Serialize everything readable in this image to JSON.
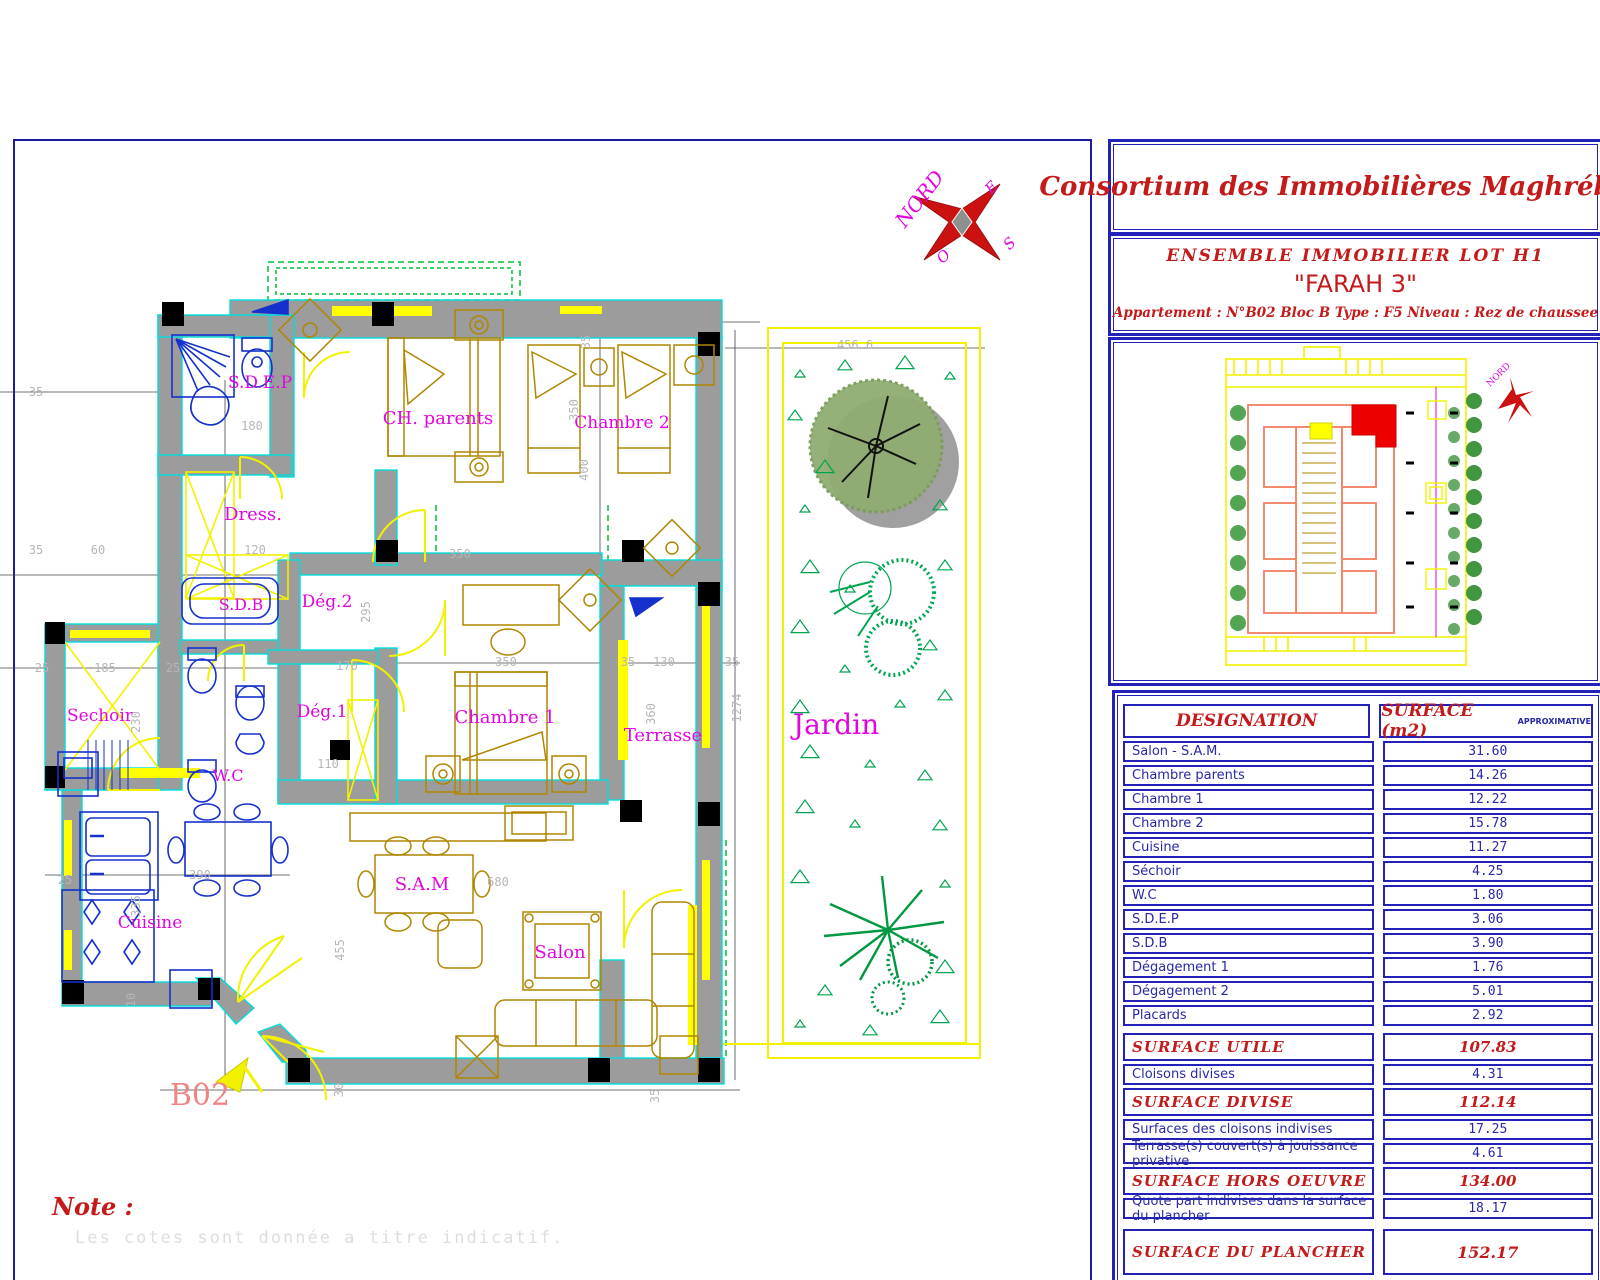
{
  "company": {
    "title": "Consortium des Immobilières Maghrébines"
  },
  "project": {
    "line1": "ENSEMBLE   IMMOBILIER LOT H1",
    "line2": "\"FARAH 3\"",
    "line3": "Appartement :  N°B02 Bloc B     Type : F5      Niveau : Rez de chaussee"
  },
  "plan_masse": {
    "label_line1": "PLAN",
    "label_line2": "MASSE"
  },
  "surface_table": {
    "header": {
      "designation": "DESIGNATION",
      "surface": "SURFACE  (m2)",
      "approx": "APPROXIMATIVE"
    },
    "rows": [
      {
        "label": "Salon - S.A.M.",
        "value": "31.60",
        "style": "normal"
      },
      {
        "label": "Chambre parents",
        "value": "14.26",
        "style": "normal"
      },
      {
        "label": "Chambre 1",
        "value": "12.22",
        "style": "normal"
      },
      {
        "label": "Chambre 2",
        "value": "15.78",
        "style": "normal"
      },
      {
        "label": "Cuisine",
        "value": "11.27",
        "style": "normal"
      },
      {
        "label": "Séchoir",
        "value": "4.25",
        "style": "normal"
      },
      {
        "label": "W.C",
        "value": "1.80",
        "style": "normal"
      },
      {
        "label": "S.D.E.P",
        "value": "3.06",
        "style": "normal"
      },
      {
        "label": "S.D.B",
        "value": "3.90",
        "style": "normal"
      },
      {
        "label": "Dégagement 1",
        "value": "1.76",
        "style": "normal"
      },
      {
        "label": "Dégagement 2",
        "value": "5.01",
        "style": "normal"
      },
      {
        "label": "Placards",
        "value": "2.92",
        "style": "normal"
      },
      {
        "label": "SURFACE  UTILE",
        "value": "107.83",
        "style": "section",
        "gap": 7
      },
      {
        "label": "Cloisons divises",
        "value": "4.31",
        "style": "normal"
      },
      {
        "label": "SURFACE  DIVISE",
        "value": "112.14",
        "style": "section"
      },
      {
        "label": "Surfaces  des  cloisons  indivises",
        "value": "17.25",
        "style": "normal"
      },
      {
        "label": "Terrasse(s)  couvert(s)  à  jouissance  privative",
        "value": "4.61",
        "style": "normal"
      },
      {
        "label": "SURFACE  HORS  OEUVRE",
        "value": "134.00",
        "style": "section"
      },
      {
        "label": "Quote  part  indivises  dans  la  surface  du  plancher",
        "value": "18.17",
        "style": "normal"
      },
      {
        "label": "SURFACE  DU  PLANCHER",
        "value": "152.17",
        "style": "plancher",
        "gap": 10
      },
      {
        "label": "Jardin",
        "value": "56.50",
        "style": "redrow",
        "gap": 10
      },
      {
        "label": "Numéro  de  la  place  de  parking",
        "value": "--",
        "style": "redrow"
      }
    ]
  },
  "floor_plan": {
    "note_title": "Note :",
    "note_text": "Les cotes sont donnée a titre indicatif.",
    "compass": {
      "n": "NORD",
      "e": "E",
      "s": "S",
      "o": "O"
    },
    "labels": [
      {
        "t": "S.D.E.P",
        "x": 260,
        "y": 388,
        "s": 17
      },
      {
        "t": "Dress.",
        "x": 253,
        "y": 520,
        "s": 18
      },
      {
        "t": "CH. parents",
        "x": 438,
        "y": 424,
        "s": 18
      },
      {
        "t": "Chambre 2",
        "x": 622,
        "y": 428,
        "s": 17
      },
      {
        "t": "S.D.B",
        "x": 241,
        "y": 610,
        "s": 16
      },
      {
        "t": "Dég.2",
        "x": 327,
        "y": 607,
        "s": 17
      },
      {
        "t": "Sechoir",
        "x": 100,
        "y": 721,
        "s": 17
      },
      {
        "t": "Dég.1",
        "x": 322,
        "y": 717,
        "s": 17
      },
      {
        "t": "Chambre 1",
        "x": 505,
        "y": 723,
        "s": 18
      },
      {
        "t": "Terrasse",
        "x": 663,
        "y": 741,
        "s": 18
      },
      {
        "t": "Jardin",
        "x": 836,
        "y": 734,
        "s": 28
      },
      {
        "t": "W.C",
        "x": 228,
        "y": 781,
        "s": 16
      },
      {
        "t": "Cuisine",
        "x": 150,
        "y": 928,
        "s": 17
      },
      {
        "t": "S.A.M",
        "x": 422,
        "y": 890,
        "s": 18
      },
      {
        "t": "Salon",
        "x": 560,
        "y": 958,
        "s": 18
      }
    ],
    "unit_label": {
      "t": "B02",
      "x": 200,
      "y": 1105,
      "s": 30
    },
    "dimensions": [
      {
        "t": "35",
        "x": 36,
        "y": 396
      },
      {
        "t": "180",
        "x": 252,
        "y": 430
      },
      {
        "t": "35",
        "x": 36,
        "y": 554
      },
      {
        "t": "60",
        "x": 98,
        "y": 554
      },
      {
        "t": "120",
        "x": 255,
        "y": 554
      },
      {
        "t": "350",
        "x": 460,
        "y": 558
      },
      {
        "t": "350",
        "x": 578,
        "y": 410,
        "r": -90
      },
      {
        "t": "170",
        "x": 347,
        "y": 670
      },
      {
        "t": "350",
        "x": 506,
        "y": 666
      },
      {
        "t": "35",
        "x": 628,
        "y": 666
      },
      {
        "t": "130",
        "x": 664,
        "y": 666
      },
      {
        "t": "35",
        "x": 732,
        "y": 666
      },
      {
        "t": "110",
        "x": 328,
        "y": 768
      },
      {
        "t": "25",
        "x": 42,
        "y": 672
      },
      {
        "t": "185",
        "x": 105,
        "y": 672
      },
      {
        "t": "25",
        "x": 173,
        "y": 672
      },
      {
        "t": "295",
        "x": 370,
        "y": 612,
        "r": -90
      },
      {
        "t": "360",
        "x": 655,
        "y": 714,
        "r": -90
      },
      {
        "t": "400",
        "x": 588,
        "y": 470,
        "r": -90
      },
      {
        "t": "35",
        "x": 590,
        "y": 342,
        "r": -90
      },
      {
        "t": "230",
        "x": 140,
        "y": 722,
        "r": -90
      },
      {
        "t": "25",
        "x": 65,
        "y": 884
      },
      {
        "t": "390",
        "x": 200,
        "y": 879
      },
      {
        "t": "335",
        "x": 140,
        "y": 906,
        "r": -90
      },
      {
        "t": "455",
        "x": 344,
        "y": 950,
        "r": -90
      },
      {
        "t": "10",
        "x": 135,
        "y": 1000,
        "r": -90
      },
      {
        "t": "30",
        "x": 343,
        "y": 1090,
        "r": -90
      },
      {
        "t": "680",
        "x": 498,
        "y": 886
      },
      {
        "t": "35",
        "x": 659,
        "y": 1096,
        "r": -90
      },
      {
        "t": "456.6",
        "x": 855,
        "y": 349
      },
      {
        "t": "1274",
        "x": 741,
        "y": 708,
        "r": -90
      }
    ]
  },
  "colors": {
    "border_navy": "#1c1c9c",
    "panel_blue": "#2222bb",
    "text_red": "#c41a1a",
    "text_blue": "#2828a8",
    "label_magenta": "#e205e2",
    "wall_gray": "#9c9c9c",
    "edge_cyan": "#00dede",
    "cad_yellow": "#ffff00",
    "furniture_olive": "#b08600",
    "fixture_blue": "#1530cc",
    "tree_green": "#00a550",
    "unit_red": "#ee0000"
  }
}
